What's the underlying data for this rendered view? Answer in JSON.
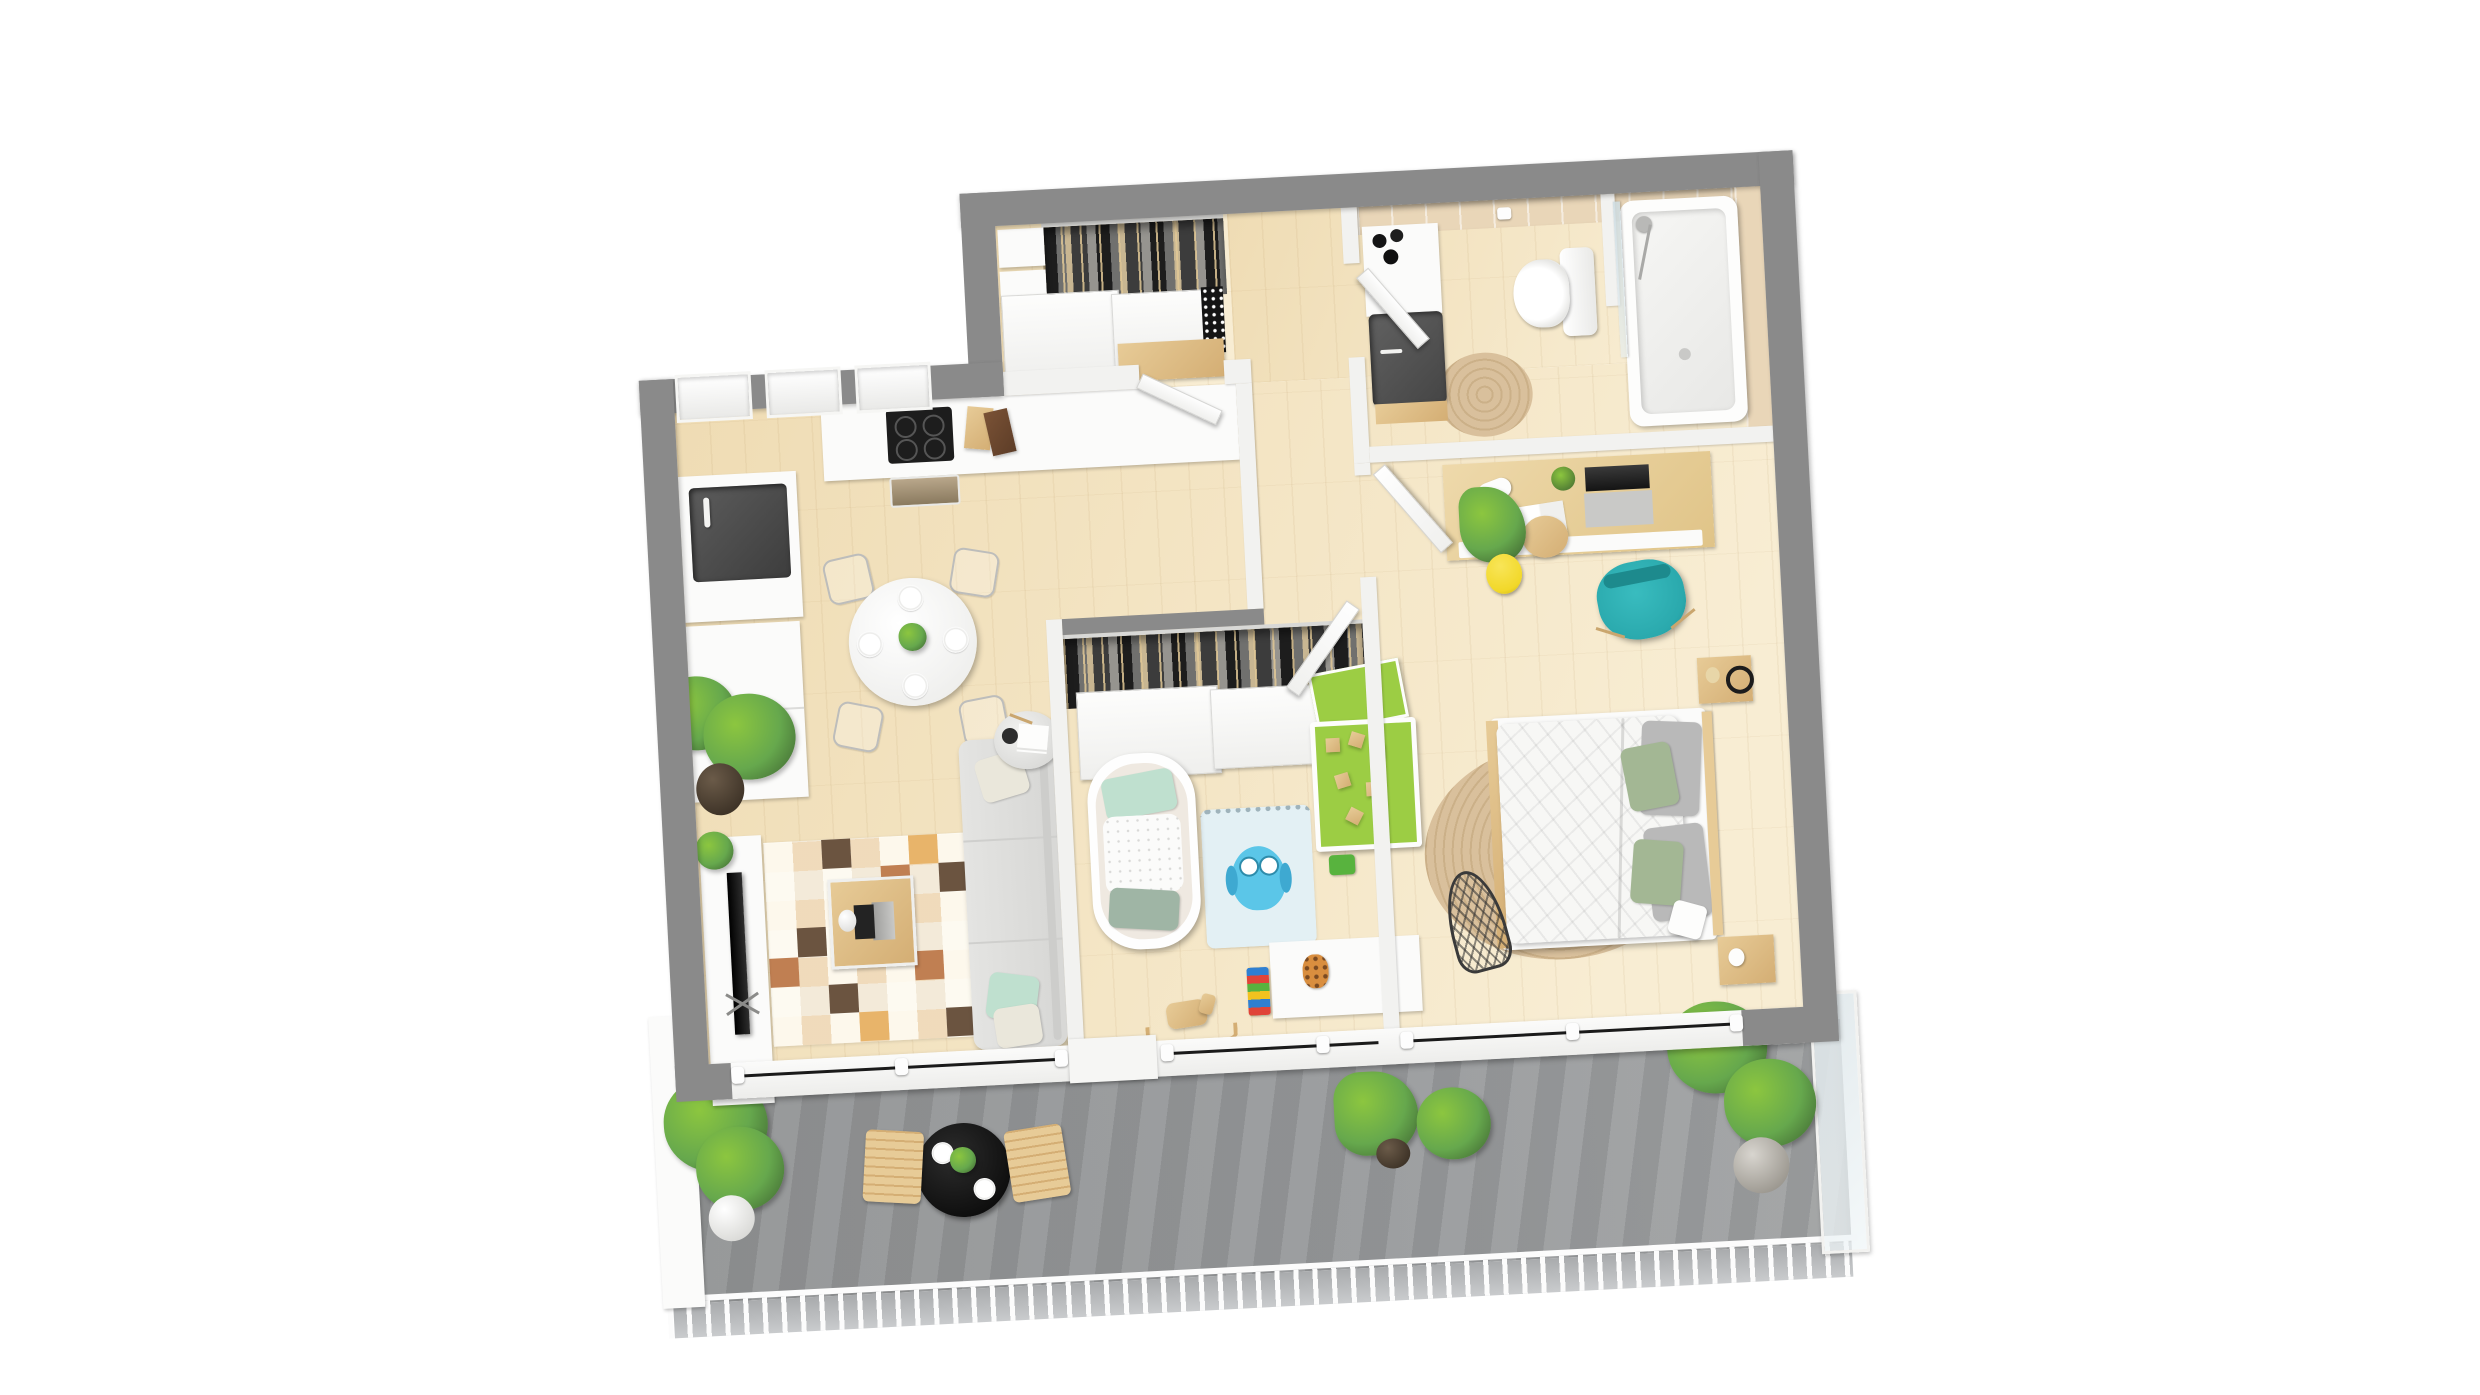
{
  "scene": {
    "title": "3D rendered top-down floor plan of a two-bedroom apartment with balcony",
    "render_style": "photorealistic dollhouse 3d floor plan, slightly rotated, no text labels",
    "colors": {
      "wall": "#8a8a8a",
      "wallface": "#f2f2f0",
      "floorwood": "#efdcb4",
      "floorwoodlight": "#f8edd3",
      "balcony": "#97999b",
      "tile": "#e9d6b8",
      "sofa": "#e4e4e2",
      "pillowmint": "#bfe0cf",
      "pillowcream": "#eae7db",
      "pillowsage": "#a3b794",
      "pillowgray": "#b9b9b9",
      "teal": "#2aa9ad",
      "yellow": "#f2d829",
      "playgreen": "#9ccd44",
      "owlblue": "#5bc6e8",
      "owlrug": "#e3f0f4",
      "jute": "#d9c09c",
      "wood": "#e7cb97",
      "wooddark": "#d4ae74",
      "dark": "#1f1f1f",
      "sinkdark": "#4e4e4e",
      "rugcream": "#f3ead9",
      "rugorange": "#e8b46a",
      "rugpeach": "#f0cfa0",
      "rugbrown": "#6b5440",
      "rugrust": "#c07f52",
      "plant": "#66a84d",
      "plantlight": "#8cc63f",
      "plantdark": "#3f6631",
      "glass": "#dfe7ea"
    },
    "rooms": [
      {
        "name": "entry-hall",
        "furniture": [
          "wall-closet-with-hanging-clothes",
          "sliding-closet-doors",
          "white-storage-cabinets",
          "wooden-bench"
        ]
      },
      {
        "name": "kitchen",
        "furniture": [
          "three-windows",
          "white-counter",
          "induction-hob-4-burners",
          "oven",
          "cutting-boards",
          "corner-sink-dark",
          "faucet",
          "fridge-tall-white-unit"
        ]
      },
      {
        "name": "dining-area",
        "furniture": [
          "round-white-table",
          "four-place-settings",
          "green-centerpiece-plant",
          "four-wire-chairs"
        ]
      },
      {
        "name": "living-room",
        "furniture": [
          "tv-media-console",
          "flatscreen-tv-on-stand",
          "large-potted-plant",
          "small-potted-plant",
          "patchwork-checkered-rug",
          "wooden-coffee-table",
          "laptop",
          "white-vase",
          "three-seat-sofa",
          "cushions-mint-cream-beige",
          "round-side-table",
          "black-lamp",
          "magazines"
        ]
      },
      {
        "name": "nursery",
        "furniture": [
          "sliding-door-wardrobe-with-clothes",
          "white-crib",
          "owl-play-rug",
          "green-play-table",
          "wooden-building-blocks",
          "green-activity-board",
          "toy-storage-unit",
          "colorful-block-tower",
          "giraffe-plush",
          "rocking-horse"
        ]
      },
      {
        "name": "bedroom",
        "furniture": [
          "desk",
          "laptop",
          "desk-lamp",
          "potted-succulent",
          "open-magazine",
          "teal-desk-chair",
          "plant-in-yellow-pot",
          "round-side-table",
          "double-bed",
          "patterned-duvet",
          "gray-and-sage-pillows",
          "two-wooden-nightstands",
          "headphones",
          "round-jute-rug",
          "wire-mannequin-decor"
        ]
      },
      {
        "name": "bathroom",
        "furniture": [
          "vanity-with-dark-basin",
          "black-toiletry-bottles",
          "toilet",
          "toilet-paper-holder",
          "bathtub",
          "glass-shower-screen",
          "shower-fixture",
          "round-jute-rug",
          "beige-wall-tiles"
        ]
      },
      {
        "name": "hallway",
        "furniture": [
          "open-white-doors"
        ]
      },
      {
        "name": "balcony",
        "furniture": [
          "white-railing",
          "concrete-floor",
          "potted-plants",
          "black-bistro-table",
          "two-place-settings",
          "potted-herb-centerpiece",
          "two-wooden-armchairs",
          "glass-side-screen"
        ]
      }
    ]
  }
}
